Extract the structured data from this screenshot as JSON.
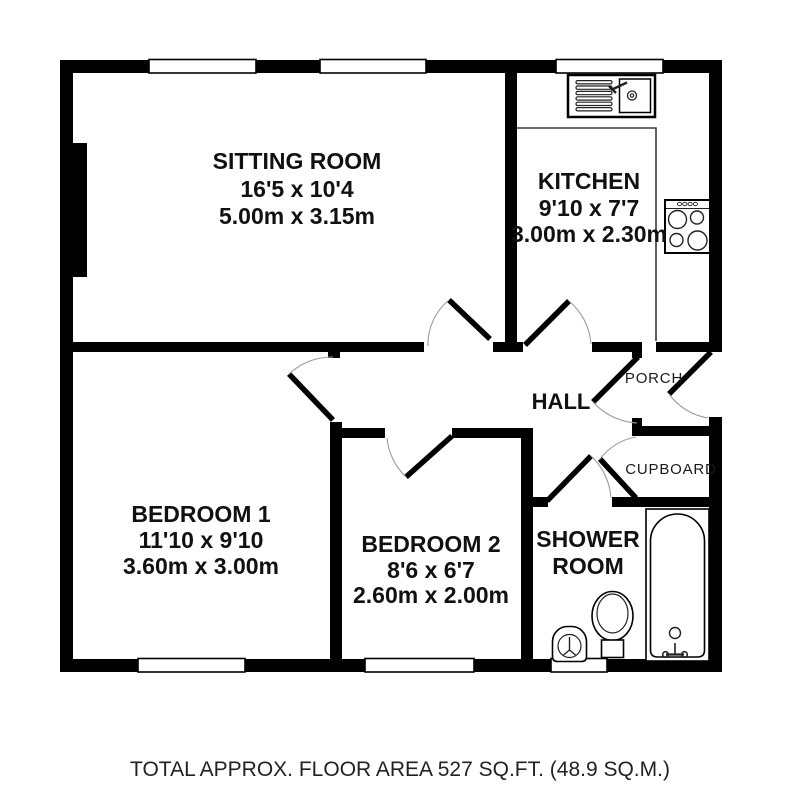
{
  "rooms": {
    "sitting_room": {
      "name": "SITTING ROOM",
      "imperial": "16'5 x 10'4",
      "metric": "5.00m x 3.15m"
    },
    "kitchen": {
      "name": "KITCHEN",
      "imperial": "9'10 x 7'7",
      "metric": "3.00m x 2.30m"
    },
    "bedroom1": {
      "name": "BEDROOM 1",
      "imperial": "11'10 x 9'10",
      "metric": "3.60m x 3.00m"
    },
    "bedroom2": {
      "name": "BEDROOM 2",
      "imperial": "8'6 x 6'7",
      "metric": "2.60m x 2.00m"
    },
    "shower_room": {
      "line1": "SHOWER",
      "line2": "ROOM"
    },
    "hall": {
      "name": "HALL"
    },
    "porch": {
      "name": "PORCH"
    },
    "cupboard": {
      "name": "CUPBOARD"
    }
  },
  "fixtures": [
    "kitchen-sink-icon",
    "hob-icon",
    "bath-icon",
    "toilet-icon",
    "wash-basin-icon"
  ],
  "footer": {
    "text": "TOTAL APPROX. FLOOR AREA 527 SQ.FT. (48.9 SQ.M.)"
  },
  "colors": {
    "wall": "#000000",
    "door_arc": "#9a9a9a",
    "text": "#111111"
  }
}
